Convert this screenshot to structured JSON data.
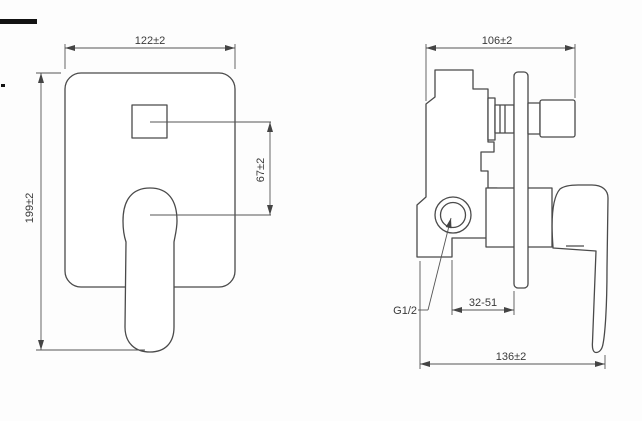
{
  "drawing": {
    "front_view": {
      "dim_width": "122±2",
      "dim_height": "199±2",
      "dim_handle_offset": "67±2"
    },
    "side_view": {
      "dim_depth": "106±2",
      "dim_install_range": "32-51",
      "dim_total_length": "136±2",
      "thread_label": "G1/2"
    },
    "colors": {
      "line": "#4a4a4a",
      "text": "#3a3a3a",
      "background": "#fdfdfd"
    }
  }
}
